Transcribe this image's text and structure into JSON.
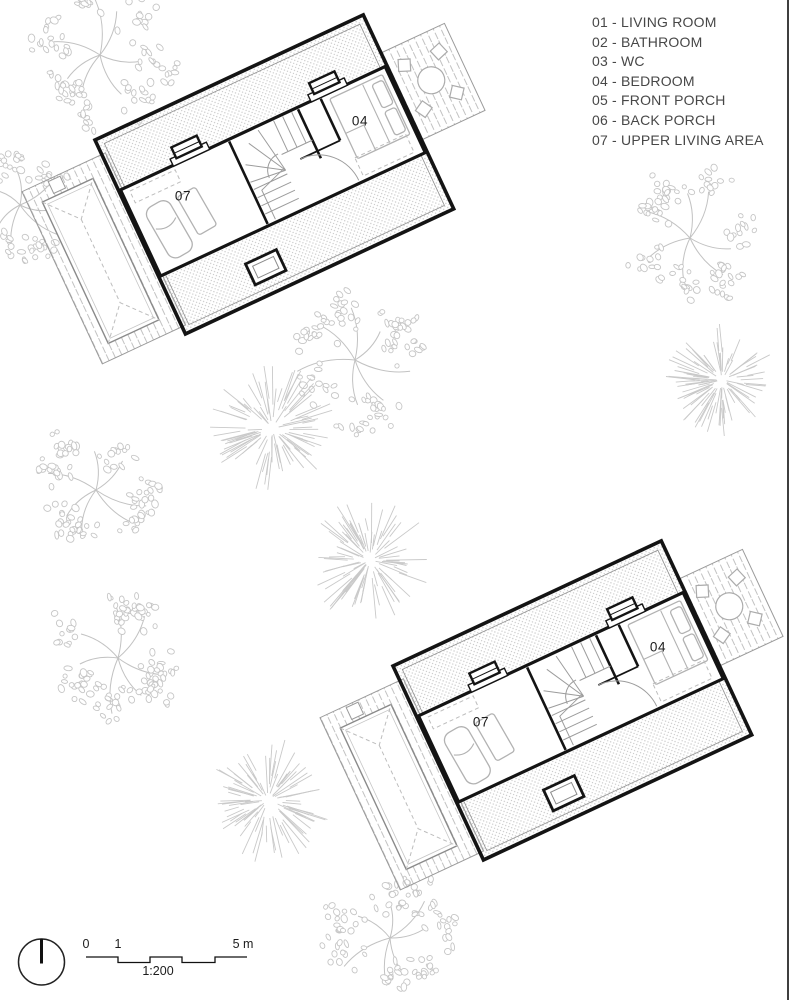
{
  "legend": {
    "items": [
      "01 - LIVING ROOM",
      "02 - BATHROOM",
      "03 - WC",
      "04 - BEDROOM",
      "05 - FRONT PORCH",
      "06 - BACK PORCH",
      "07 - UPPER LIVING AREA"
    ]
  },
  "floor_plans": [
    {
      "name": "upper-floor-plan-top",
      "room_labels": [
        "07",
        "04"
      ]
    },
    {
      "name": "upper-floor-plan-bottom",
      "room_labels": [
        "07",
        "04"
      ]
    }
  ],
  "scale_bar": {
    "ticks": [
      "0",
      "1",
      "5 m"
    ],
    "ratio": "1:200"
  },
  "icons": {
    "north": "north-arrow-circle-icon"
  },
  "site": {
    "trees": [
      {
        "type": "leafy",
        "cx": 100,
        "cy": 55,
        "r": 72
      },
      {
        "type": "leafy",
        "cx": 20,
        "cy": 205,
        "r": 58
      },
      {
        "type": "leafy",
        "cx": 355,
        "cy": 360,
        "r": 72
      },
      {
        "type": "spiky",
        "cx": 272,
        "cy": 428,
        "r": 62
      },
      {
        "type": "leafy",
        "cx": 690,
        "cy": 238,
        "r": 66
      },
      {
        "type": "spiky",
        "cx": 722,
        "cy": 380,
        "r": 56
      },
      {
        "type": "leafy",
        "cx": 96,
        "cy": 490,
        "r": 62
      },
      {
        "type": "leafy",
        "cx": 118,
        "cy": 658,
        "r": 66
      },
      {
        "type": "spiky",
        "cx": 370,
        "cy": 560,
        "r": 62
      },
      {
        "type": "spiky",
        "cx": 268,
        "cy": 800,
        "r": 62
      },
      {
        "type": "leafy",
        "cx": 390,
        "cy": 938,
        "r": 68
      }
    ]
  },
  "colors": {
    "ink": "#141414",
    "line_gray": "#9a9a9a",
    "furniture_gray": "#b2b2b2",
    "pattern_gray": "#c4c4c4",
    "tree_gray": "#c9c9c9",
    "text_gray": "#474747",
    "background": "#ffffff",
    "edge_line": "#3f3f3f"
  }
}
